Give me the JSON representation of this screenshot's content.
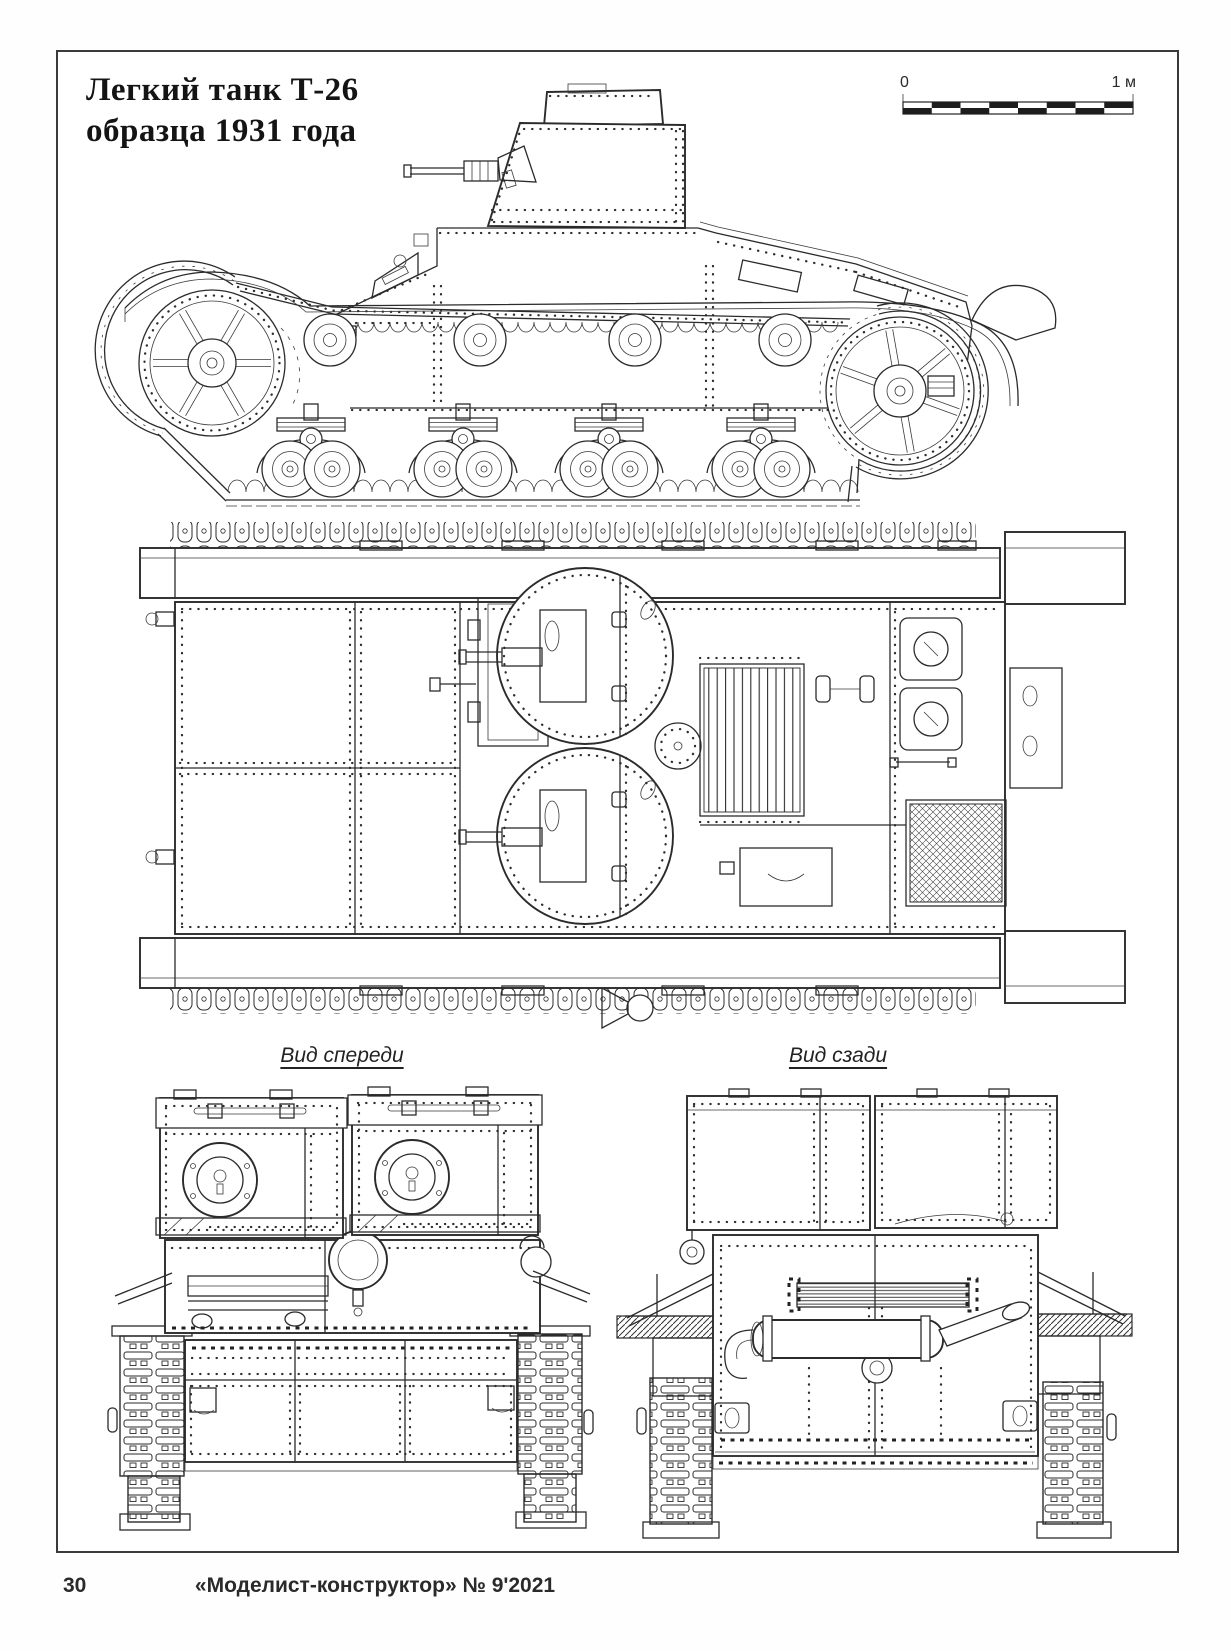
{
  "header": {
    "title_line1": "Легкий танк Т-26",
    "title_line2": "образца 1931 года"
  },
  "scale_bar": {
    "left_label": "0",
    "right_label": "1 м"
  },
  "view_labels": {
    "front": "Вид спереди",
    "rear": "Вид сзади"
  },
  "drawings": {
    "side_view": "side view drawing",
    "top_view": "top view drawing",
    "front_view": "front view drawing",
    "rear_view": "rear view drawing"
  },
  "footer": {
    "page_number": "30",
    "magazine_credit": "«Моделист-конструктор» № 9'2021"
  },
  "colors": {
    "ink": "#2b2b2b",
    "paper": "#ffffff"
  }
}
